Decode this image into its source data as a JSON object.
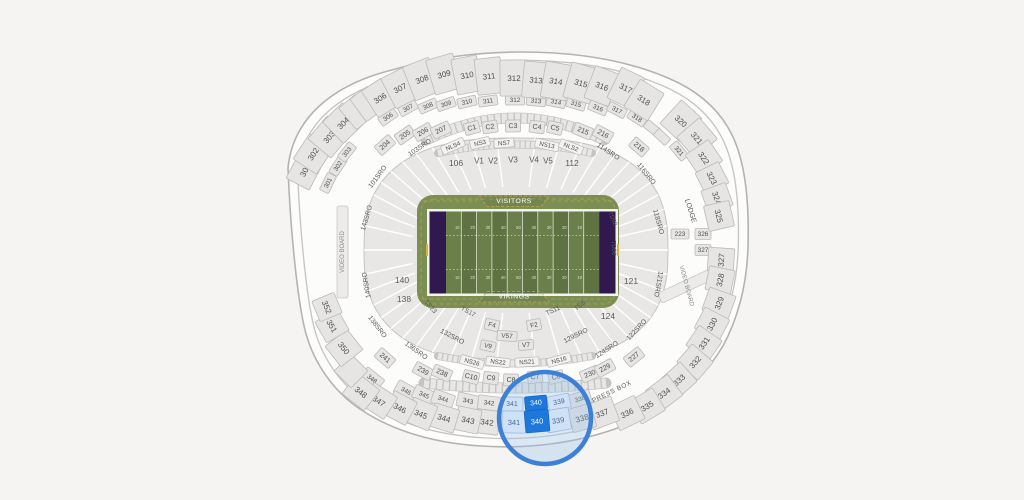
{
  "page": {
    "background": "#f5f4f2"
  },
  "map": {
    "center": {
      "x": 516,
      "y": 250
    },
    "colors": {
      "shell": "#fcfcfb",
      "shellStroke": "#b5b3b1",
      "shellInner": "#c7c5c3",
      "section": "#e6e5e3",
      "sectionStroke": "#bcbab8",
      "text": "#4f4f4f",
      "band": "#e8e7e5",
      "bandStroke": "#c6c4c2",
      "divider": "#ffffff",
      "nsFill": "#f3f2f0",
      "highlight": "#1e78dc",
      "highlightStroke": "#1767c4",
      "lightBlue": "#cfe1f7",
      "lightBlueStroke": "#9db9dd",
      "lightBlueText": "#4b6c96",
      "magnifierStroke": "#3d80d8",
      "magnifierFill": "rgba(150,190,235,0.33)"
    },
    "shell": {
      "d": "M 288,168 C 293,118 332,86 388,71 C 441,56 482,52 521,52 C 576,52 626,60 668,78 C 706,94 729,119 739,153 C 747,179 749,213 748,247 C 747,282 739,316 723,346 C 701,383 666,409 623,426 C 576,444 526,449 481,446 C 431,443 386,429 353,404 C 326,383 309,353 303,321 C 296,286 290,222 288,168 Z"
    },
    "bowl": {
      "a": 152,
      "b": 112,
      "e": 2.6,
      "ia": 104,
      "ib": 63,
      "dividers": 46
    },
    "tick_bands": [
      {
        "d": "M 426,140 Q 516,96 604,140",
        "w1": 11,
        "w2": 9.5,
        "dash": "5.2 1.4"
      },
      {
        "d": "M 424,383 Q 516,393 606,383",
        "w1": 11,
        "w2": 9.5,
        "dash": "5.2 1.4"
      },
      {
        "d": "M 438,153 Q 516,136 592,153",
        "w1": 8,
        "w2": 6.5,
        "dash": "4 1.2"
      },
      {
        "d": "M 438,356 Q 516,371 592,356",
        "w1": 8,
        "w2": 6.5,
        "dash": "4 1.2"
      }
    ],
    "rows": [
      {
        "name": "level200",
        "w": 19,
        "h": 12,
        "fs": 7,
        "items": [
          [
            "204",
            385,
            145
          ],
          [
            "205",
            405,
            135
          ],
          [
            "206",
            423,
            132
          ],
          [
            "207",
            441,
            130
          ],
          [
            "C1",
            472,
            128,
            15
          ],
          [
            "C2",
            490,
            127,
            15
          ],
          [
            "C3",
            513,
            126,
            15
          ],
          [
            "C4",
            537,
            127,
            15
          ],
          [
            "C5",
            555,
            128,
            15
          ],
          [
            "215",
            583,
            131
          ],
          [
            "216",
            603,
            134
          ],
          [
            "218",
            639,
            147,
            18
          ],
          [
            "241",
            385,
            358
          ],
          [
            "239",
            423,
            371
          ],
          [
            "238",
            442,
            373
          ],
          [
            "C10",
            471,
            377,
            16
          ],
          [
            "C9",
            491,
            378,
            15
          ],
          [
            "C8",
            511,
            380,
            15
          ],
          [
            "C7",
            535,
            377,
            15
          ],
          [
            "C6",
            556,
            377,
            15
          ],
          [
            "230",
            590,
            374
          ],
          [
            "229",
            605,
            368
          ],
          [
            "227",
            634,
            357
          ]
        ]
      },
      {
        "name": "nsboxes",
        "w": 24,
        "h": 9,
        "fs": 6.2,
        "fill": "#f3f2f0",
        "stroke": "#c1bfbb",
        "items": [
          [
            "NLS4",
            453,
            146
          ],
          [
            "NS3",
            480,
            143,
            20
          ],
          [
            "NS7",
            504,
            143,
            20
          ],
          [
            "NS13",
            547,
            145
          ],
          [
            "NLS2",
            571,
            147
          ],
          [
            "NS26",
            472,
            362
          ],
          [
            "NS22",
            498,
            362
          ],
          [
            "NS21",
            527,
            362
          ],
          [
            "NS16",
            559,
            360
          ]
        ]
      },
      {
        "name": "vfboxes",
        "w": 14,
        "h": 11,
        "fs": 6.5,
        "items": [
          [
            "F4",
            492,
            325
          ],
          [
            "F2",
            534,
            325
          ],
          [
            "V57",
            507,
            336,
            20,
            10
          ],
          [
            "V9",
            488,
            346,
            15,
            10
          ],
          [
            "V7",
            526,
            345,
            15,
            10
          ]
        ]
      },
      {
        "name": "suites",
        "w": 19,
        "h": 10,
        "fs": 6.4,
        "items": [
          [
            "301",
            328,
            183
          ],
          [
            "302",
            338,
            166
          ],
          [
            "303",
            347,
            152
          ],
          [
            "306",
            388,
            117
          ],
          [
            "307",
            408,
            108
          ],
          [
            "308",
            428,
            106
          ],
          [
            "309",
            446,
            104
          ],
          [
            "310",
            467,
            102
          ],
          [
            "311",
            488,
            101
          ],
          [
            "312",
            515,
            100
          ],
          [
            "313",
            536,
            101
          ],
          [
            "314",
            556,
            102
          ],
          [
            "315",
            576,
            104
          ],
          [
            "316",
            598,
            108
          ],
          [
            "317",
            617,
            110
          ],
          [
            "318",
            637,
            118
          ],
          [
            "",
            652,
            128,
            16,
            9
          ],
          [
            "",
            662,
            137,
            16,
            9
          ],
          [
            "321",
            679,
            151
          ],
          [
            "223",
            680,
            234,
            18,
            10,
            0
          ],
          [
            "326",
            703,
            234,
            16,
            11,
            0
          ],
          [
            "327",
            703,
            250,
            16,
            11,
            0
          ],
          [
            "348",
            372,
            379,
            22,
            14
          ],
          [
            "346",
            406,
            391,
            22,
            14
          ],
          [
            "345",
            424,
            395,
            22,
            14
          ],
          [
            "344",
            443,
            399,
            22,
            14
          ],
          [
            "343",
            468,
            401,
            22,
            14
          ],
          [
            "342",
            489,
            403,
            22,
            14
          ],
          [
            "338",
            580,
            399,
            22,
            14
          ]
        ]
      },
      {
        "name": "upper300",
        "w": 26,
        "h": 32,
        "fs": 8,
        "items": [
          [
            "301",
            305,
            170,
            32,
            26
          ],
          [
            "302",
            313,
            154,
            30,
            28
          ],
          [
            "303",
            329,
            137,
            30,
            30
          ],
          [
            "304",
            343,
            123,
            28,
            30
          ],
          [
            "",
            356,
            112,
            22,
            28
          ],
          [
            "",
            367,
            104,
            22,
            28
          ],
          [
            "306",
            380,
            98,
            24,
            32
          ],
          [
            "307",
            400,
            88,
            26,
            34
          ],
          [
            "308",
            422,
            79,
            28,
            36
          ],
          [
            "309",
            444,
            74,
            28,
            36
          ],
          [
            "310",
            467,
            75,
            26,
            36
          ],
          [
            "311",
            489,
            76,
            26,
            36
          ],
          [
            "312",
            514,
            78,
            28,
            36
          ],
          [
            "313",
            536,
            80,
            26,
            36
          ],
          [
            "314",
            556,
            81,
            26,
            36
          ],
          [
            "315",
            581,
            83,
            28,
            36
          ],
          [
            "316",
            602,
            86,
            26,
            34
          ],
          [
            "317",
            626,
            88,
            26,
            34
          ],
          [
            "318",
            644,
            100,
            28,
            32
          ],
          [
            "320",
            681,
            121,
            28,
            32
          ],
          [
            "321",
            697,
            138,
            28,
            30
          ],
          [
            "322",
            704,
            158,
            26,
            28
          ],
          [
            "323",
            712,
            178,
            24,
            26
          ],
          [
            "324",
            717,
            198,
            24,
            26
          ],
          [
            "325",
            719,
            216,
            26,
            26
          ],
          [
            "327",
            721,
            260,
            24,
            26
          ],
          [
            "328",
            720,
            280,
            24,
            26
          ],
          [
            "329",
            719,
            303,
            24,
            28
          ],
          [
            "330",
            712,
            324,
            24,
            28
          ],
          [
            "331",
            704,
            343,
            24,
            28
          ],
          [
            "332",
            695,
            362,
            24,
            28
          ],
          [
            "333",
            679,
            380,
            26,
            26
          ],
          [
            "334",
            664,
            393,
            28,
            26
          ],
          [
            "335",
            647,
            406,
            28,
            26
          ],
          [
            "336",
            627,
            413,
            28,
            26
          ],
          [
            "337",
            602,
            413,
            28,
            26
          ],
          [
            "338",
            582,
            418,
            24,
            24
          ],
          [
            "342",
            487,
            422,
            24,
            24
          ],
          [
            "343",
            468,
            420,
            24,
            24
          ],
          [
            "344",
            444,
            418,
            26,
            24
          ],
          [
            "345",
            421,
            414,
            26,
            26
          ],
          [
            "346",
            400,
            408,
            26,
            26
          ],
          [
            "347",
            379,
            401,
            28,
            26
          ],
          [
            "348",
            361,
            392,
            28,
            26
          ],
          [
            "",
            351,
            371,
            24,
            24
          ],
          [
            "350",
            344,
            348,
            26,
            28
          ],
          [
            "351",
            332,
            326,
            24,
            26
          ],
          [
            "352",
            327,
            307,
            22,
            24
          ]
        ]
      }
    ],
    "circle_sections": [
      {
        "t": "341",
        "x": 512,
        "y": 404,
        "w": 22,
        "h": 14,
        "k": "light"
      },
      {
        "t": "339",
        "x": 559,
        "y": 402,
        "w": 22,
        "h": 14,
        "k": "light"
      },
      {
        "t": "340",
        "x": 536,
        "y": 403,
        "w": 22,
        "h": 14,
        "k": "bright"
      },
      {
        "t": "341",
        "x": 514,
        "y": 422,
        "w": 24,
        "h": 22,
        "k": "light"
      },
      {
        "t": "339",
        "x": 558,
        "y": 420,
        "w": 24,
        "h": 22,
        "k": "light"
      },
      {
        "t": "340",
        "x": 537,
        "y": 421,
        "w": 24,
        "h": 22,
        "k": "bright"
      }
    ],
    "labels": [
      {
        "t": "106",
        "x": 456,
        "y": 163,
        "fs": 8.5,
        "rot": 0
      },
      {
        "t": "V1",
        "x": 479,
        "y": 161,
        "fs": 8,
        "rot": 0
      },
      {
        "t": "V2",
        "x": 493,
        "y": 161,
        "fs": 8,
        "rot": 0
      },
      {
        "t": "V3",
        "x": 513,
        "y": 160,
        "fs": 8,
        "rot": 0
      },
      {
        "t": "V4",
        "x": 534,
        "y": 160,
        "fs": 8,
        "rot": 0
      },
      {
        "t": "V5",
        "x": 548,
        "y": 161,
        "fs": 8,
        "rot": 0
      },
      {
        "t": "112",
        "x": 572,
        "y": 163,
        "fs": 8.5,
        "rot": 0
      },
      {
        "t": "121",
        "x": 631,
        "y": 281,
        "fs": 8.5,
        "rot": 0
      },
      {
        "t": "124",
        "x": 608,
        "y": 316,
        "fs": 8.5,
        "rot": 0
      },
      {
        "t": "140",
        "x": 402,
        "y": 280,
        "fs": 8.5,
        "rot": 0
      },
      {
        "t": "138",
        "x": 404,
        "y": 299,
        "fs": 8.5,
        "rot": 0
      },
      {
        "t": "TS23",
        "x": 430,
        "y": 307,
        "fs": 6.5
      },
      {
        "t": "TS17",
        "x": 468,
        "y": 312,
        "fs": 6.5
      },
      {
        "t": "TS11",
        "x": 553,
        "y": 311,
        "fs": 6.5
      },
      {
        "t": "TS6",
        "x": 580,
        "y": 306,
        "fs": 6.5
      },
      {
        "t": "TD52",
        "x": 612,
        "y": 219,
        "fs": 6
      },
      {
        "t": "TD56",
        "x": 613,
        "y": 248,
        "fs": 6
      },
      {
        "t": "101SRO",
        "x": 378,
        "y": 177,
        "fs": 6.8
      },
      {
        "t": "103SRO",
        "x": 420,
        "y": 148,
        "fs": 6.8
      },
      {
        "t": "114SRO",
        "x": 608,
        "y": 152,
        "fs": 6.8
      },
      {
        "t": "116SRO",
        "x": 646,
        "y": 174,
        "fs": 6.8
      },
      {
        "t": "118SRO",
        "x": 658,
        "y": 222,
        "fs": 6.8
      },
      {
        "t": "121SRO",
        "x": 658,
        "y": 284,
        "fs": 6.8,
        "rot": 100
      },
      {
        "t": "122SRO",
        "x": 637,
        "y": 330,
        "fs": 6.8
      },
      {
        "t": "124SRO",
        "x": 607,
        "y": 350,
        "fs": 6.8
      },
      {
        "t": "129SRO",
        "x": 576,
        "y": 336,
        "fs": 6.8
      },
      {
        "t": "132SRO",
        "x": 452,
        "y": 337,
        "fs": 6.8
      },
      {
        "t": "136SRO",
        "x": 416,
        "y": 351,
        "fs": 6.8
      },
      {
        "t": "138SRO",
        "x": 377,
        "y": 327,
        "fs": 6.8
      },
      {
        "t": "140SRO",
        "x": 367,
        "y": 285,
        "fs": 6.8,
        "rot": -100
      },
      {
        "t": "143SRO",
        "x": 367,
        "y": 218,
        "fs": 6.8
      },
      {
        "t": "LODGE",
        "x": 690,
        "y": 211,
        "fs": 7
      },
      {
        "t": "PRESS BOX",
        "x": 612,
        "y": 392,
        "fs": 6.5,
        "ls": 0.6,
        "n": "label-press-box"
      },
      {
        "t": "VIDEO BOARD",
        "x": 343,
        "y": 252,
        "fs": 6,
        "rot": -90,
        "c": "#8a8a88",
        "n": "label-video-board-left"
      },
      {
        "t": "VIDEO BOARD",
        "x": 686,
        "y": 286,
        "fs": 6,
        "rot": 75,
        "c": "#8a8a88",
        "n": "label-video-board-right"
      }
    ],
    "video_boards": [
      {
        "x": 342.5,
        "y": 252,
        "w": 11,
        "h": 92,
        "rot": 0
      },
      {
        "x": 686,
        "y": 286,
        "w": 11,
        "h": 58,
        "rot": 65
      }
    ],
    "field": {
      "apron": {
        "x": 417,
        "y": 195,
        "w": 202,
        "h": 113,
        "r": 16,
        "fill": "#7b8e54"
      },
      "border": {
        "x": 427,
        "y": 209,
        "w": 191,
        "h": 87,
        "fill": "#f4f4ee"
      },
      "inner": {
        "x": 429.5,
        "y": 211.5,
        "w": 186,
        "h": 82
      },
      "endzoneW": 16.5,
      "endzoneFill": "#30194e",
      "stripeA": "#6a7f49",
      "stripeB": "#5f7342",
      "goldDash": "#c4a94e",
      "yardNumbers": [
        "10",
        "20",
        "30",
        "40",
        "50",
        "40",
        "30",
        "20",
        "10"
      ],
      "home_label": "VIKINGS",
      "away_label": "VISITORS",
      "labelColor": "#ffffff"
    },
    "magnifier": {
      "cx": 545,
      "cy": 418,
      "r": 46,
      "sw": 4.5
    }
  }
}
